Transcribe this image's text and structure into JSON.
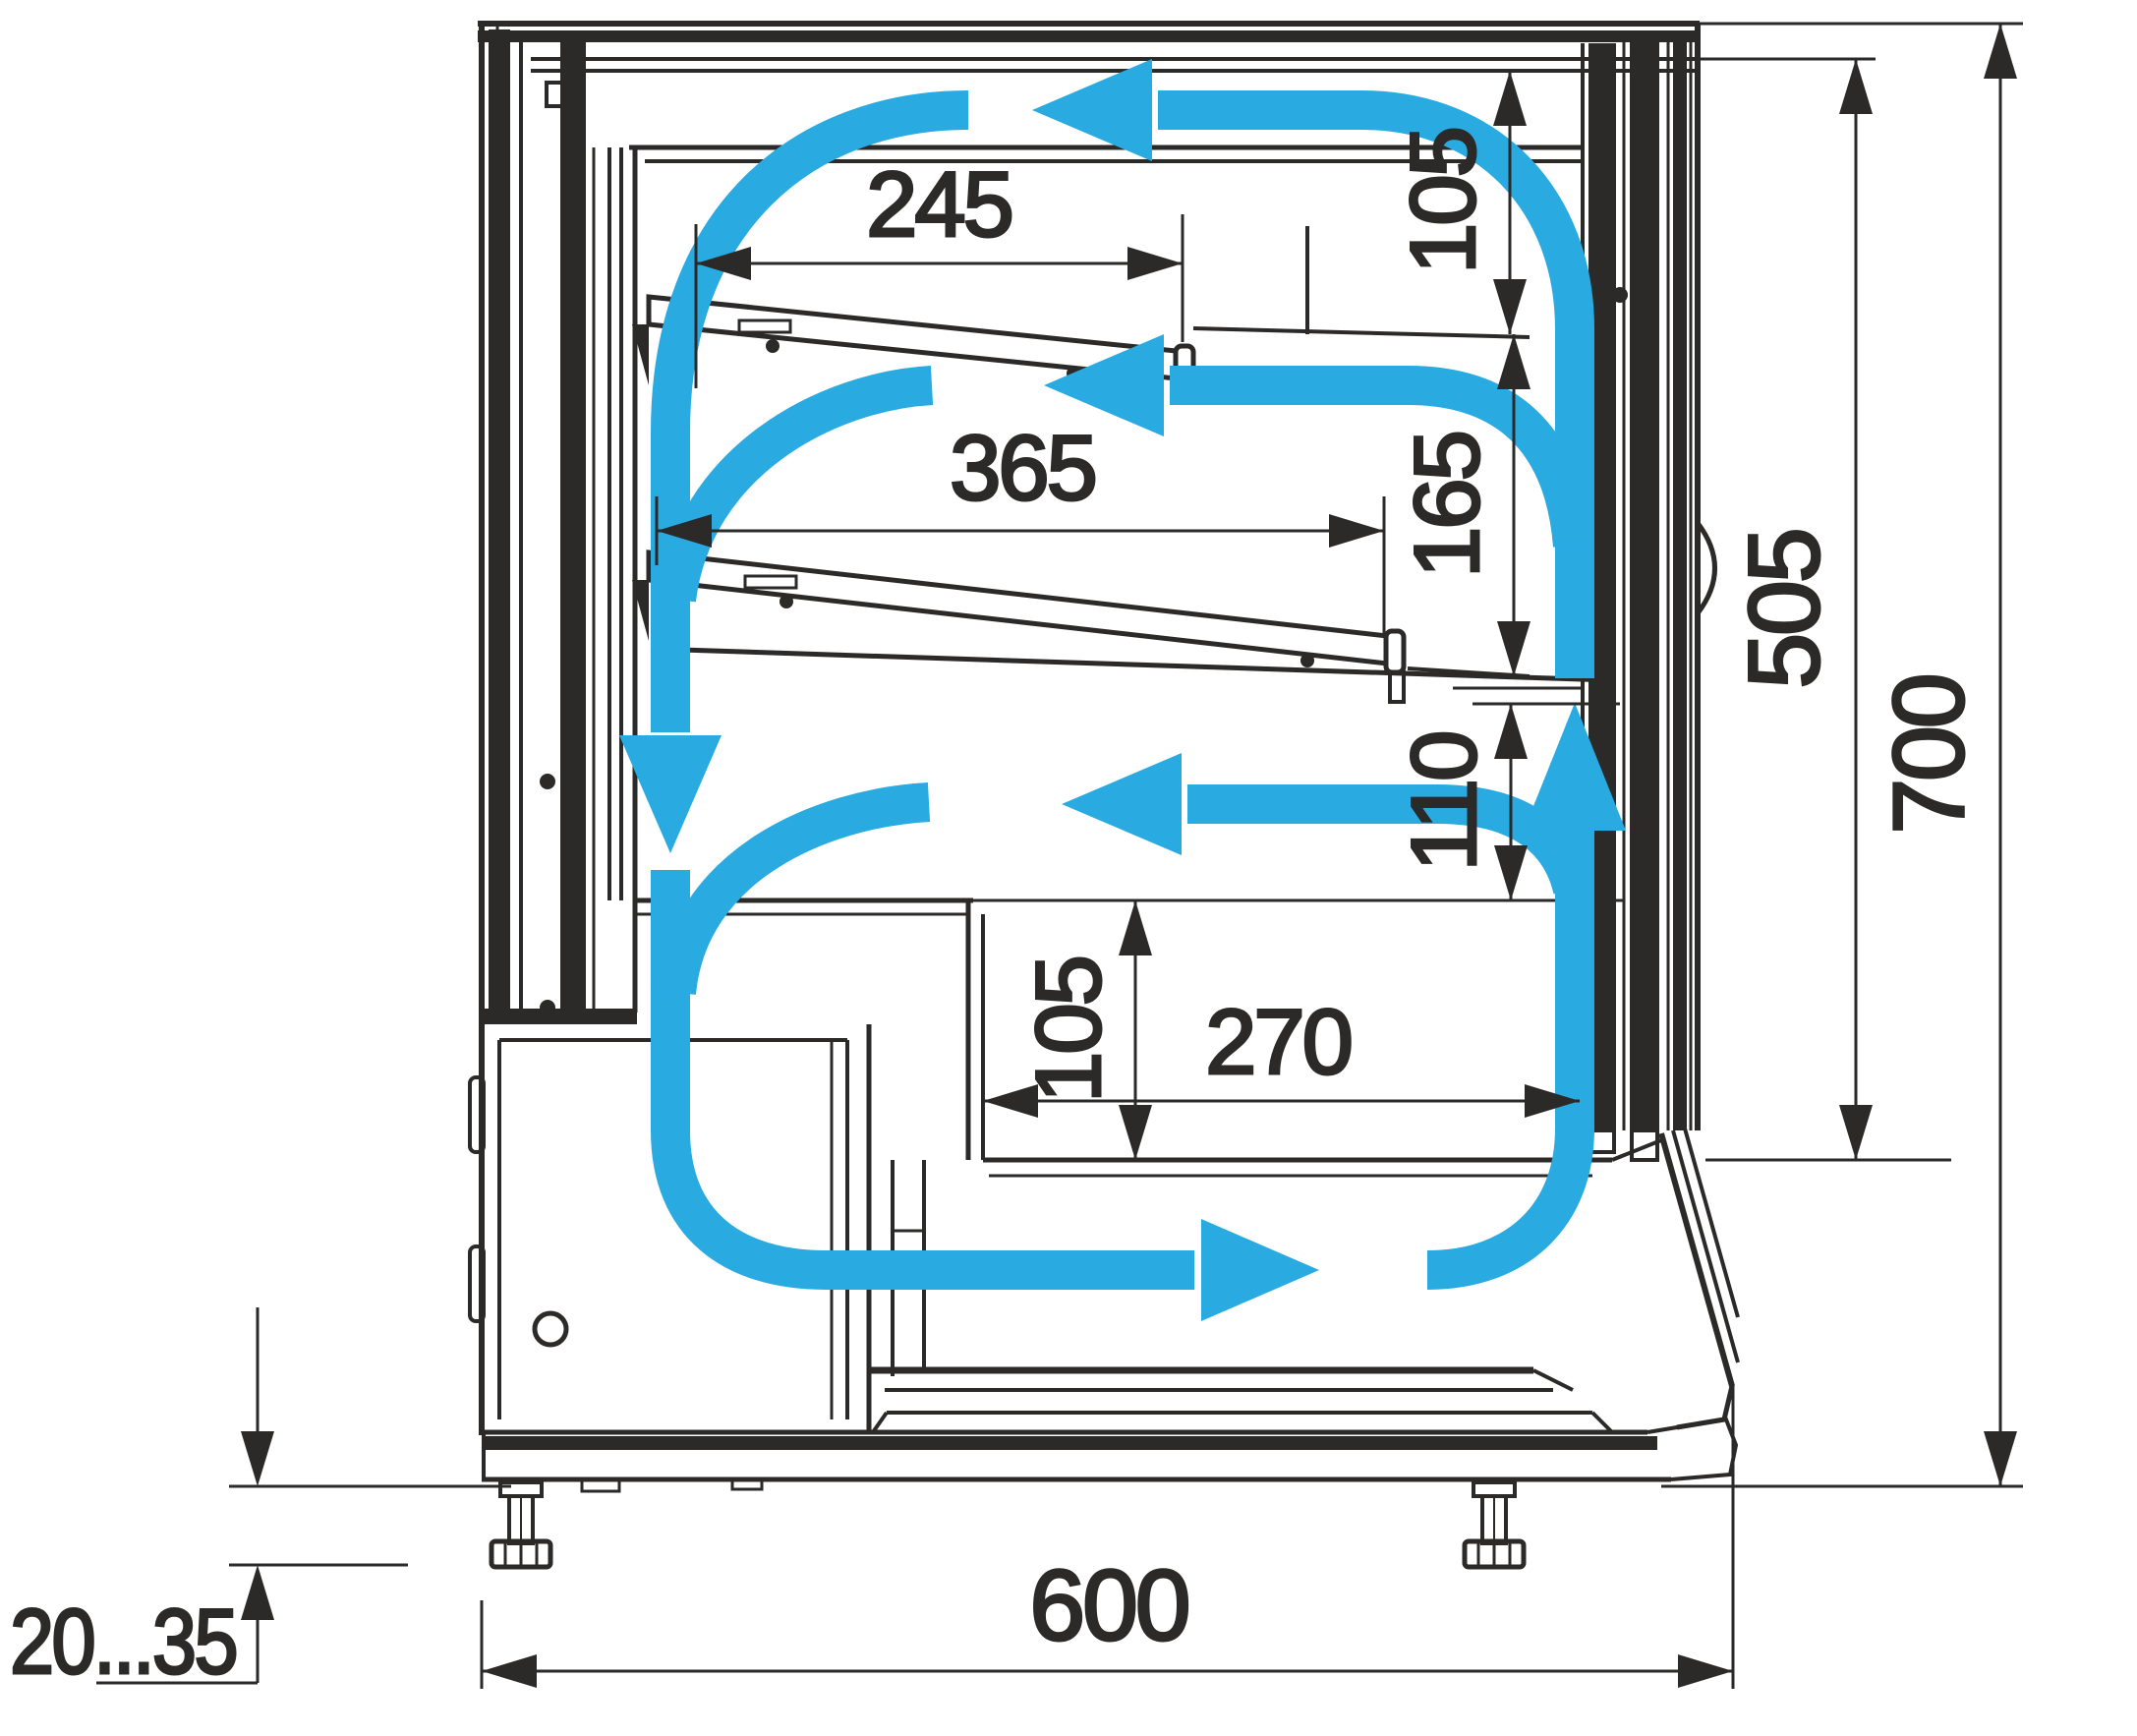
{
  "diagram": {
    "title": "refrigerated-display-case-section",
    "type": "technical-drawing-side-section-with-airflow",
    "colors": {
      "line": "#2B2A29",
      "airflow": "#29ABE2",
      "background": "#FFFFFF"
    },
    "dimensions": {
      "top_shelf_depth": "245",
      "top_gap_height": "105",
      "middle_shelf_depth": "365",
      "middle_gap_height": "165",
      "lower_gap_height": "110",
      "well_step_height": "105",
      "well_width": "270",
      "interior_height": "505",
      "overall_height": "700",
      "overall_depth": "600",
      "foot_adjust_range": "20...35"
    }
  }
}
